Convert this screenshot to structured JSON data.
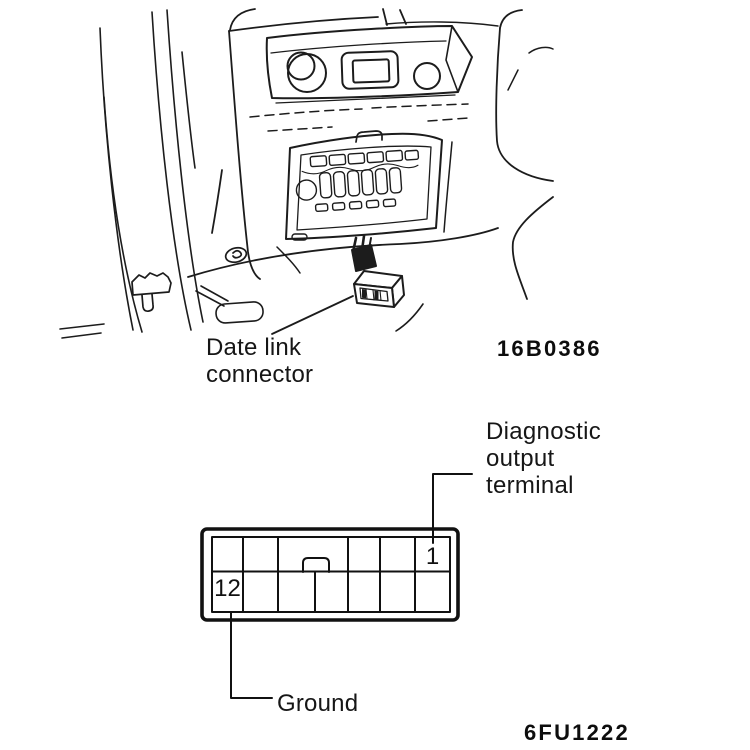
{
  "figure_top": {
    "callout": "Date link\nconnector",
    "code": "16B0386"
  },
  "figure_bottom": {
    "pin1": "1",
    "pin12": "12",
    "pin1_callout": "Diagnostic\noutput\nterminal",
    "pin12_callout": "Ground",
    "code": "6FU1222"
  }
}
